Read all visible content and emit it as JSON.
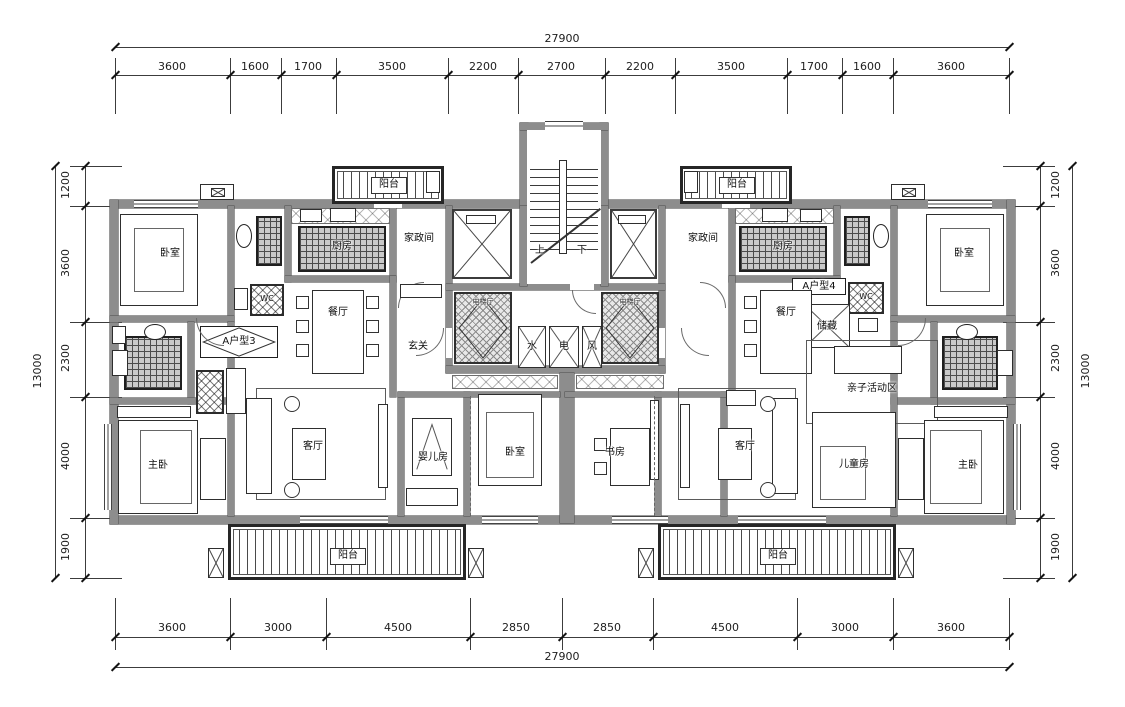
{
  "drawing": {
    "type": "residential floor plan",
    "units": {
      "left": "A户型3",
      "right": "A户型4"
    }
  },
  "dimensions": {
    "top": {
      "total": "27900",
      "segments": [
        "3600",
        "1600",
        "1700",
        "3500",
        "2200",
        "2700",
        "2200",
        "3500",
        "1700",
        "1600",
        "3600"
      ]
    },
    "bottom": {
      "total": "27900",
      "segments": [
        "3600",
        "3000",
        "4500",
        "2850",
        "2850",
        "4500",
        "3000",
        "3600"
      ]
    },
    "left": {
      "total": "13000",
      "segments": [
        "1200",
        "3600",
        "2300",
        "4000",
        "1900"
      ]
    },
    "right": {
      "total": "13000",
      "segments": [
        "1200",
        "3600",
        "2300",
        "4000",
        "1900"
      ]
    }
  },
  "rooms": {
    "bedroom": "卧室",
    "master_bedroom": "主卧",
    "living_room": "客厅",
    "dining_room": "餐厅",
    "kitchen": "厨房",
    "housekeeping": "家政间",
    "balcony": "阳台",
    "foyer": "玄关",
    "baby_room": "婴儿房",
    "study": "书房",
    "kids_room": "儿童房",
    "activity_area": "亲子活动区",
    "storage": "储藏",
    "wc": "WC",
    "elevator_hall": "电梯厅"
  },
  "stair": {
    "up": "上",
    "down": "下"
  },
  "shafts": {
    "water": "水",
    "electric": "电",
    "vent": "风"
  },
  "colors": {
    "wall": "#8d8d8d",
    "line": "#3c3c3c",
    "background": "#ffffff"
  }
}
